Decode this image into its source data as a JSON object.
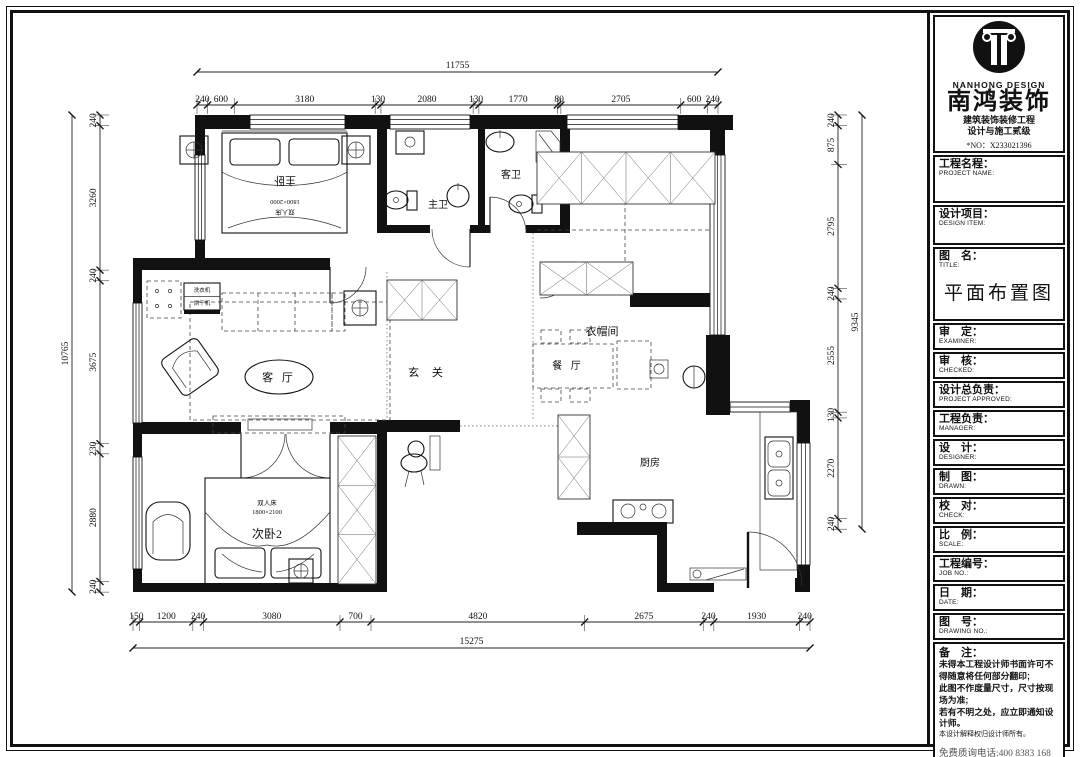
{
  "title_block": {
    "logo": {
      "en": "NANHONG DESIGN",
      "cn": "南鸿装饰",
      "cert1": "建筑装饰装修工程",
      "cert2": "设计与施工贰级",
      "no": "*NO：X233021396"
    },
    "project_name": {
      "cn": "工程名程：",
      "en": "PROJECT NAME:"
    },
    "design_item": {
      "cn": "设计项目：",
      "en": "DESIGN ITEM:"
    },
    "drawing": {
      "cn": "图　名：",
      "en": "TITLE:",
      "value": "平面布置图"
    },
    "examiner": {
      "cn": "审　定：",
      "en": "EXAMINER:"
    },
    "checked": {
      "cn": "审　核：",
      "en": "CHECKED:"
    },
    "approved": {
      "cn": "设计总负责：",
      "en": "PROJECT APPROVED:"
    },
    "manager": {
      "cn": "工程负责：",
      "en": "MANAGER:"
    },
    "designer": {
      "cn": "设　计：",
      "en": "DESIGNER:"
    },
    "drawn": {
      "cn": "制　图：",
      "en": "DRAWN:"
    },
    "check": {
      "cn": "校　对：",
      "en": "CHECK:"
    },
    "scale": {
      "cn": "比　例：",
      "en": "SCALE:"
    },
    "job_no": {
      "cn": "工程编号：",
      "en": "JOB NO.:"
    },
    "date": {
      "cn": "日　期：",
      "en": "DATE:"
    },
    "drawing_no": {
      "cn": "图　号：",
      "en": "DRAWING NO.:"
    },
    "remark_title": "备　注：",
    "remarks": [
      "未得本工程设计师书面许可不得随意将任何部分翻印;",
      "此图不作度量尺寸，尺寸按现场为准;",
      "若有不明之处，应立即通知设计师。"
    ],
    "remark_small": "本设计解释权归设计师所有。",
    "phone": "免费质询电话:400 8383 168"
  },
  "plan": {
    "rooms": {
      "master_bedroom": "主卧",
      "master_bed_size": "1800×2000",
      "master_bed_type": "双人床",
      "master_bath": "主卫",
      "guest_bath": "客卫",
      "cloakroom": "衣帽间",
      "foyer": "玄 关",
      "living_room": "客 厅",
      "dining_room": "餐 厅",
      "kitchen": "厨房",
      "bedroom2": "次卧2",
      "bedroom2_bed_type": "双人床",
      "bedroom2_bed_size": "1800×2100",
      "laundry_washer": "洗衣机",
      "laundry_dryer": "烘干机"
    },
    "dims": {
      "top": {
        "overall": "11755",
        "segments": [
          "240",
          "600",
          "3180",
          "130",
          "2080",
          "130",
          "1770",
          "80",
          "2705",
          "600",
          "240"
        ]
      },
      "bottom": {
        "overall": "15275",
        "segments": [
          "150",
          "1200",
          "240",
          "3080",
          "700",
          "4820",
          "2675",
          "240",
          "1930",
          "240"
        ]
      },
      "left": {
        "overall": "10765",
        "segments": [
          "240",
          "3260",
          "240",
          "3675",
          "230",
          "2880",
          "240"
        ]
      },
      "right": {
        "overall": "9345",
        "segments": [
          "240",
          "875",
          "2795",
          "240",
          "2555",
          "130",
          "2270",
          "240"
        ]
      }
    }
  }
}
